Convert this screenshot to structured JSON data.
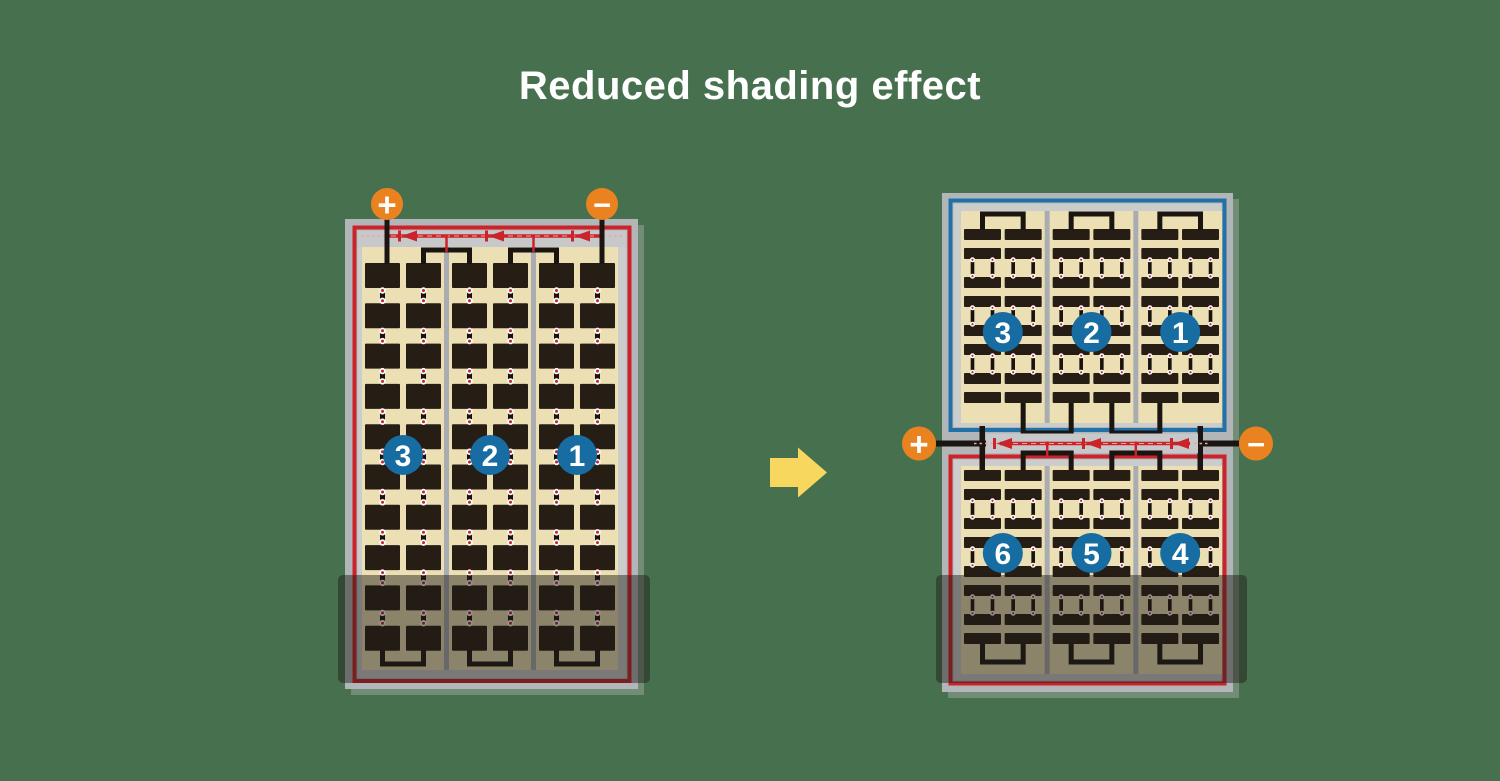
{
  "title": "Reduced shading effect",
  "colors": {
    "background": "#47714E",
    "title_text": "#FFFFFF",
    "panel_frame": "#B3B6B9",
    "panel_inner": "#CBCDCD",
    "bus_strip": "#C6C8CA",
    "divider": "#A9ADB1",
    "cell_bg": "#EBDFB3",
    "cell": "#261D14",
    "wire_black": "#1A1511",
    "wire_red": "#CB2329",
    "wire_red_light": "#EFA49F",
    "wire_blue": "#2271A6",
    "label_circle": "#176CA2",
    "label_text": "#FFFFFF",
    "terminal": "#EA831F",
    "terminal_text": "#FFFFFF",
    "arrow": "#F8D75F",
    "shade": "rgba(31,28,23,0.47)",
    "panel_shadow": "rgba(168,173,168,0.45)",
    "link_red": "#C1272D",
    "link_ring": "#FFFFFF"
  },
  "left_panel": {
    "terminals": {
      "positive": "+",
      "negative": "−"
    },
    "group_labels": [
      "3",
      "2",
      "1"
    ]
  },
  "right_panel": {
    "top_half": {
      "group_labels": [
        "3",
        "2",
        "1"
      ]
    },
    "bottom_half": {
      "group_labels": [
        "6",
        "5",
        "4"
      ]
    },
    "terminals": {
      "positive": "+",
      "negative": "−"
    }
  }
}
